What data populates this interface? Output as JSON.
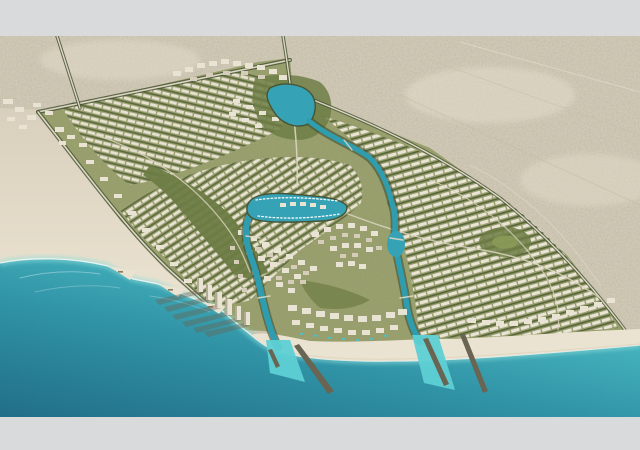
{
  "meta": {
    "description": "Aerial rendering of a triangular coastal master-planned resort community surrounded by desert, with a beachfront of turquoise sea, winding canals, a central marina with boats, villa districts, a mid-rise downtown, beachfront towers with long shadows, and two breakwater-protected canal outlets to the sea.",
    "media_type": "architectural-aerial-render",
    "letterboxed": true
  },
  "palette": {
    "frame": "#d9dadb",
    "desert": "#d1c9b6",
    "sand_far": "#d8d0bc",
    "sand_near": "#eee6d4",
    "beach": "#ebe3d1",
    "sea_deep": "#1f6d86",
    "sea_mid": "#2f93a6",
    "sea_shallow": "#45b4be",
    "sea_shore": "#58c7ca",
    "parcel": "#9aa06e",
    "green_dark": "#465434",
    "green_mid": "#6d7c45",
    "road": "#ddd6c2",
    "building": "#e9e3d4",
    "building_mid": "#d5cdb9",
    "building_dark": "#b3aa96",
    "canal": "#2e9db0",
    "lagoon": "#35a3b5",
    "outlet": "#5ed0d4",
    "jetty": "#6a6452",
    "shadow": "#6b6150",
    "pool": "#49c3cf"
  },
  "scene": {
    "features": [
      "desert-terrain",
      "light-coastal-sand",
      "sea",
      "bay-beach-with-sand-spits",
      "development-parcel",
      "villa-districts",
      "central-park",
      "lagoon",
      "canal-network",
      "marina-with-boats",
      "downtown-midrise",
      "resort-beach-strip",
      "beachfront-towers",
      "tower-shadows",
      "breakwater-jetties",
      "canal-outlets",
      "perimeter-roads",
      "desert-access-roads"
    ]
  }
}
